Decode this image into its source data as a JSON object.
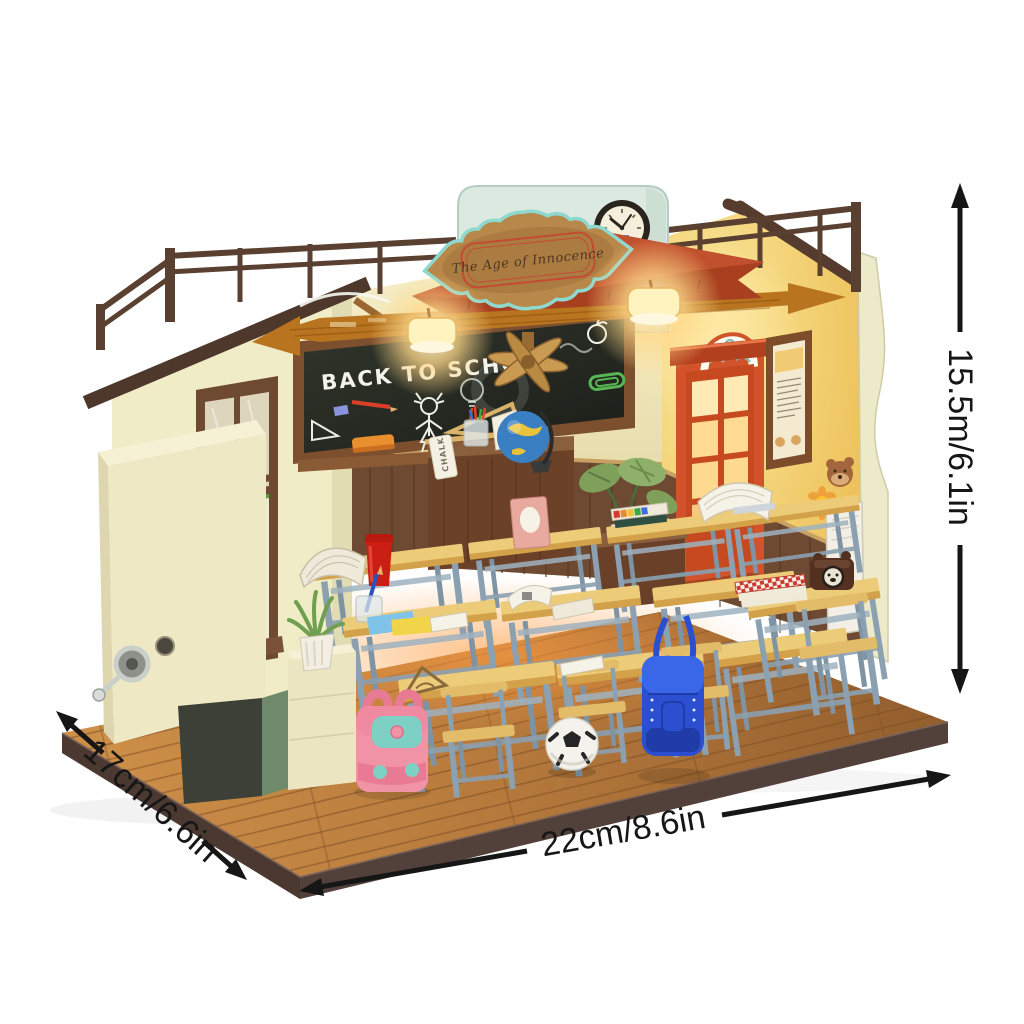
{
  "annotations": {
    "height_label": "15.5m/6.1in",
    "depth_label": "17cm/6.6in",
    "width_label": "22cm/8.6in"
  },
  "model": {
    "banner_sign": "The Age of Innocence",
    "chalkboard_text": "BACK TO SCHOOL",
    "chalk_box_label": "CHALK"
  },
  "colors": {
    "arrow": "#161616",
    "background": "#ffffff",
    "base_wood": "#b5793c",
    "base_rim": "#4a3831",
    "wall_cream": "#f0ecc6",
    "wall_yellow": "#f3cd62",
    "headboard_mint": "#dce9e0",
    "door_orange": "#d2532b",
    "chalkboard": "#262a22",
    "desk_top": "#eccb79",
    "desk_leg": "#8ba0b0",
    "backpack_pink": "#f193a7",
    "backpack_blue": "#2b4fd0",
    "banner_teal": "#8fd8cf",
    "banner_red": "#c0502e",
    "lamp_glow": "#ffd98a"
  }
}
